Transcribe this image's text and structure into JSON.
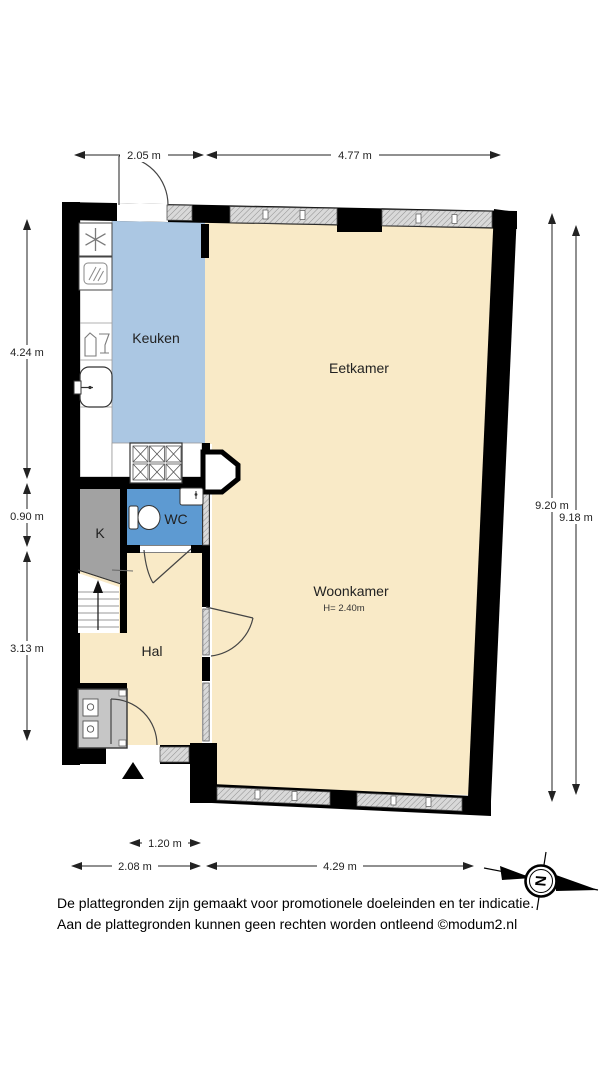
{
  "floorplan": {
    "rooms": {
      "keuken": {
        "label": "Keuken"
      },
      "eetkamer": {
        "label": "Eetkamer"
      },
      "woonkamer": {
        "label": "Woonkamer",
        "ceiling_height": "H= 2.40m"
      },
      "wc": {
        "label": "WC"
      },
      "kast": {
        "label": "K"
      },
      "hal": {
        "label": "Hal"
      }
    },
    "dimensions": {
      "top": [
        "2.05 m",
        "4.77 m"
      ],
      "left": [
        "4.24 m",
        "0.90 m",
        "3.13 m"
      ],
      "right": [
        "9.20 m",
        "9.18 m"
      ],
      "bottom_inner": "1.20 m",
      "bottom": [
        "2.08 m",
        "4.29 m"
      ]
    },
    "compass": {
      "north_label": "N"
    },
    "colors": {
      "wall": "#000000",
      "kitchen_floor": "#abc7e3",
      "wc_floor": "#5d9ad2",
      "living_floor": "#f9eac7",
      "closet": "#a2a2a2",
      "meter_cupboard": "#c6c6c6",
      "window_band": "#d9d9d9"
    },
    "footer": {
      "line1": "De plattegronden zijn gemaakt voor promotionele doeleinden en ter indicatie.",
      "line2": "Aan de plattegronden kunnen geen rechten worden ontleend ©modum2.nl"
    }
  }
}
